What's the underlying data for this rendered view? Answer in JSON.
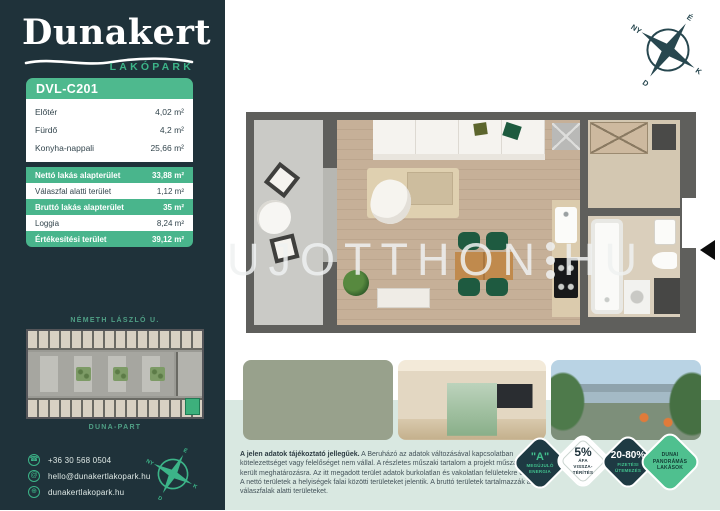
{
  "brand": {
    "name": "Dunakert",
    "subtitle": "LAKÓPARK"
  },
  "unit": {
    "id": "DVL-C201"
  },
  "rooms": [
    {
      "label": "Előtér",
      "area": "4,02 m²"
    },
    {
      "label": "Fürdő",
      "area": "4,2 m²"
    },
    {
      "label": "Konyha-nappali",
      "area": "25,66 m²"
    }
  ],
  "summary": [
    {
      "label": "Nettó lakás alapterület",
      "area": "33,88 m²"
    },
    {
      "label": "Válaszfal alatti terület",
      "area": "1,12 m²"
    },
    {
      "label": "Bruttó lakás alapterület",
      "area": "35 m²"
    },
    {
      "label": "Loggia",
      "area": "8,24 m²"
    },
    {
      "label": "Értékesítési terület",
      "area": "39,12 m²"
    }
  ],
  "siteplan": {
    "street_top": "NÉMETH LÁSZLÓ U.",
    "street_bottom": "DUNA-PART"
  },
  "contact": {
    "phone": "+36 30 568 0504",
    "email": "hello@dunakertlakopark.hu",
    "website": "dunakertlakopark.hu",
    "icons": {
      "phone": "☎",
      "email": "@",
      "website": "⊕"
    }
  },
  "compass": {
    "n": "É",
    "e": "K",
    "s": "D",
    "w": "NY"
  },
  "watermark": {
    "left": "UJOTTHON",
    "right": "HU"
  },
  "disclaimer": {
    "lead": "A jelen adatok tájékoztató jellegűek.",
    "body": " A Beruházó az adatok változásával kapcsolatban kötelezettséget vagy felelőséget nem vállal. A részletes műszaki tartalom a projekt műszaki leírásában került meghatározásra. Az itt megadott terület adatok burkolatlan és vakolatlan felületekre értendőek. A nettó területek a helyiségek falai közötti területeket jelentik. A bruttó területek tartalmazzák a válaszfalak alatti területeket."
  },
  "badges": [
    {
      "big": "\"A\"",
      "small": "MEGÚJULÓ ENERGIA"
    },
    {
      "big": "5%",
      "small": "ÁFA VISSZA- TÉRÍTÉS"
    },
    {
      "big": "20-80%",
      "small": "FIZETÉSI ÜTEMEZÉS"
    },
    {
      "big": "",
      "small": "DUNAI PANORÁMÁS LAKÁSOK"
    }
  ],
  "colors": {
    "sidebar_bg": "#1f323a",
    "accent_green": "#3cb488",
    "row_green": "#49b58c",
    "mint_band": "#d9e8e1",
    "badge_dark": "#1e3a43",
    "badge_green": "#4fc08f"
  }
}
